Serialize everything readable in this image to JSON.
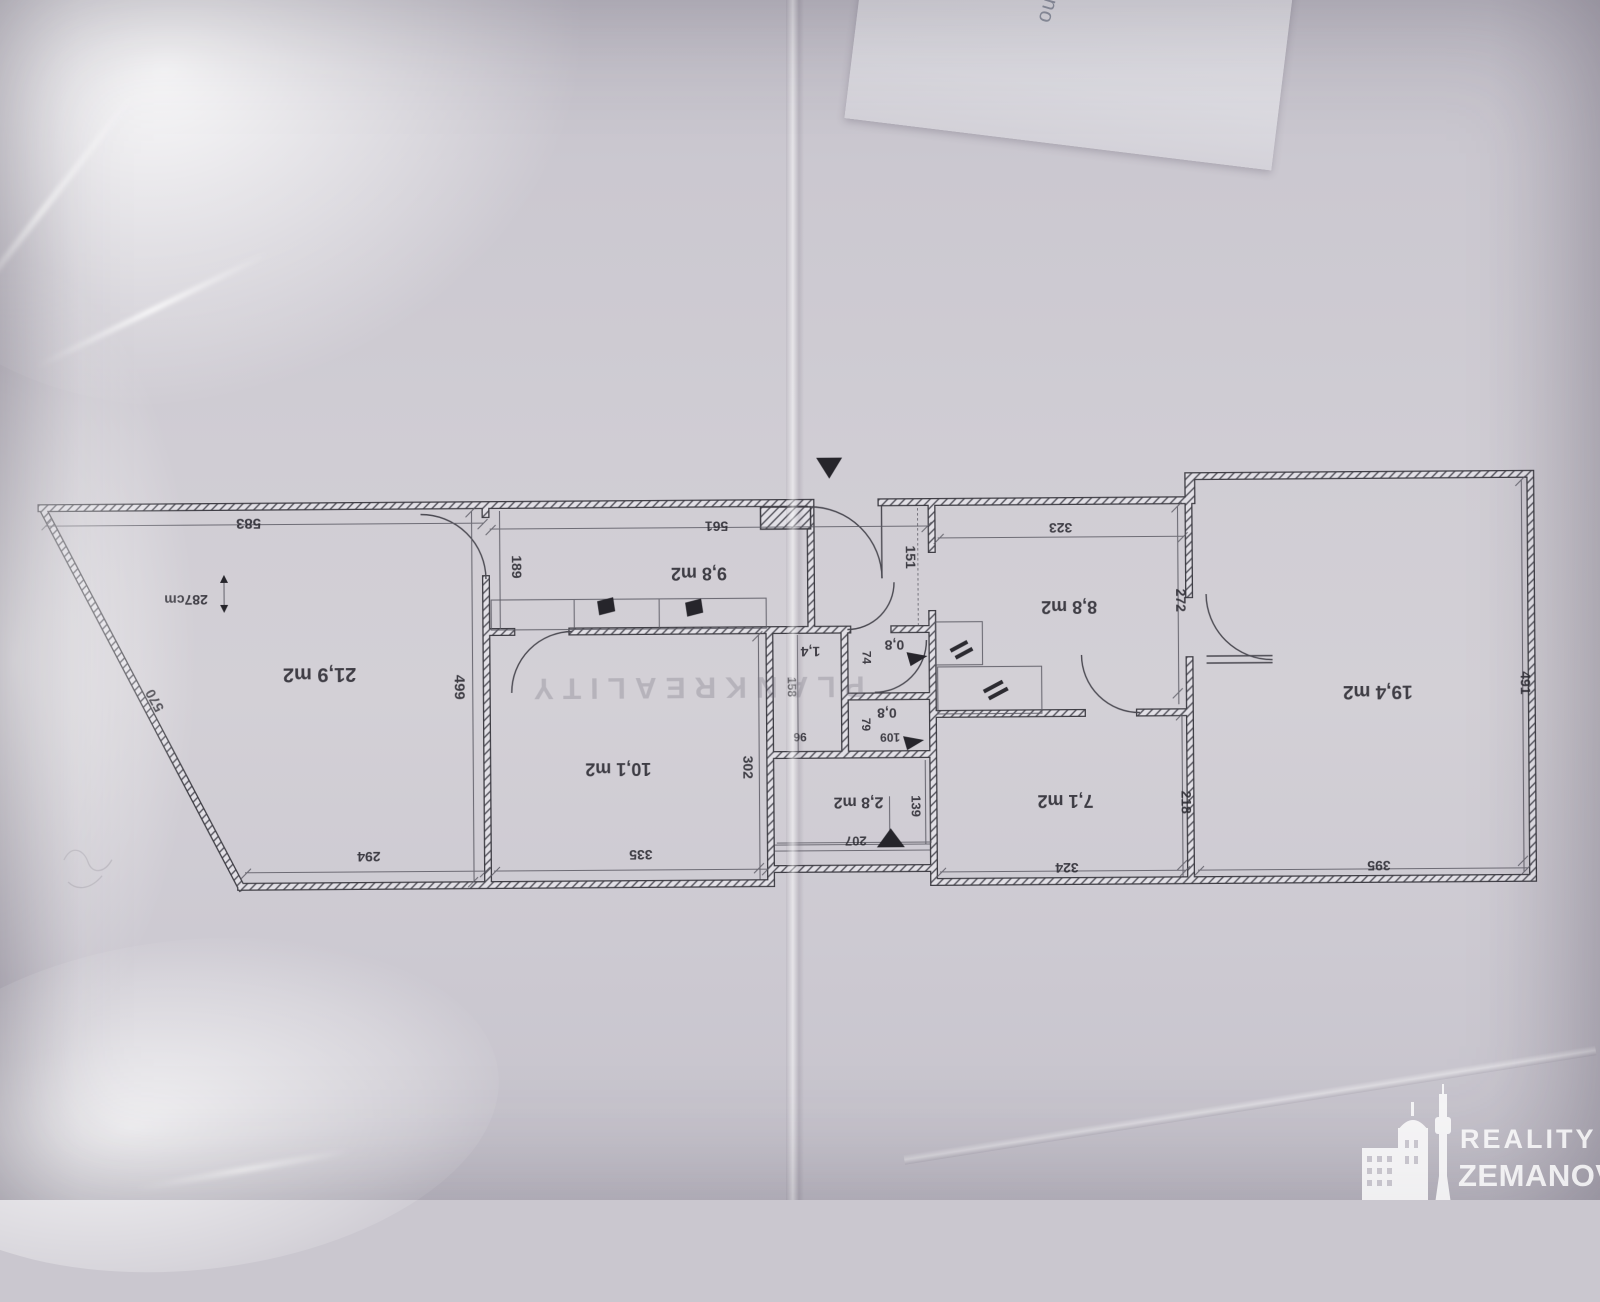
{
  "photo": {
    "back_sheet_text": "leno",
    "watermark_text": "PLANKREALITY",
    "logo": {
      "line1": "REALITY",
      "line2": "ZEMANOVÁ"
    },
    "colors": {
      "paper": "#cfccd4",
      "ink": "#3e3d44",
      "logo_white": "#ffffff"
    }
  },
  "plan": {
    "height_note": "287cm",
    "rooms": {
      "room_219": "21,9 m2",
      "room_98": "9,8 m2",
      "room_101": "10,1 m2",
      "room_14": "1,4",
      "room_08a": "0,8",
      "room_08b": "0,8",
      "room_28": "2,8 m2",
      "room_88": "8,8 m2",
      "room_71": "7,1 m2",
      "room_194": "19,4 m2"
    },
    "dimensions_cm": {
      "d583": "583",
      "d570": "570",
      "d499": "499",
      "d294": "294",
      "d189": "189",
      "d561": "561",
      "d335": "335",
      "d302": "302",
      "d151": "151",
      "d158": "158",
      "d96": "96",
      "d74": "74",
      "d79": "79",
      "d109": "109",
      "d207": "207",
      "d139": "139",
      "d323": "323",
      "d272": "272",
      "d324": "324",
      "d218": "218",
      "d395": "395",
      "d491": "491"
    }
  }
}
